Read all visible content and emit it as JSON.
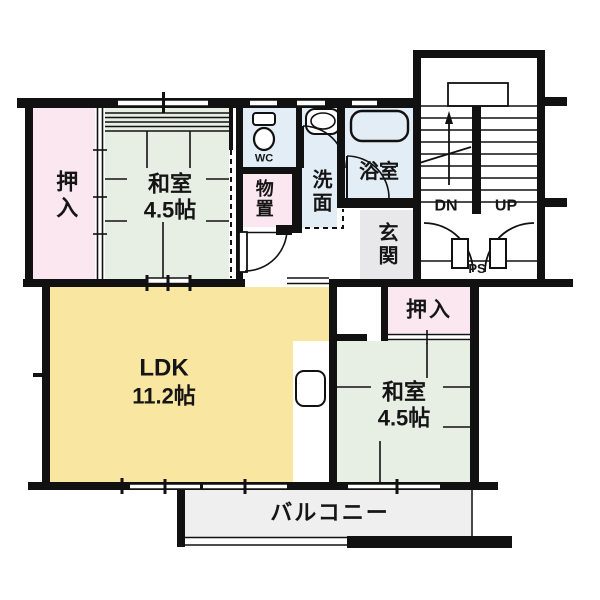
{
  "title": "Japanese apartment floor plan",
  "colors": {
    "wall": "#111111",
    "line": "#111111",
    "tatami": "#e7efe5",
    "closet_pink": "#fbe7ef",
    "water_blue": "#e3edf6",
    "ldk_yellow": "#f8e6a1",
    "balcony_gray": "#efefef",
    "genkan_gray": "#e8e8eb"
  },
  "rooms": {
    "oshiire_left": {
      "label": "押入"
    },
    "washitsu_top": {
      "label": "和室",
      "size": "4.5帖"
    },
    "wc": {
      "label": "WC"
    },
    "monooki": {
      "label": "物置"
    },
    "senmen": {
      "label": "洗面"
    },
    "yokushitsu": {
      "label": "浴室"
    },
    "genkan": {
      "label": "玄関"
    },
    "oshiire_right": {
      "label": "押入"
    },
    "washitsu_bottom": {
      "label": "和室",
      "size": "4.5帖"
    },
    "ldk": {
      "label": "LDK",
      "size": "11.2帖"
    },
    "balcony": {
      "label": "バルコニー"
    }
  },
  "stairs": {
    "down": "DN",
    "up": "UP",
    "ps": "PS"
  }
}
